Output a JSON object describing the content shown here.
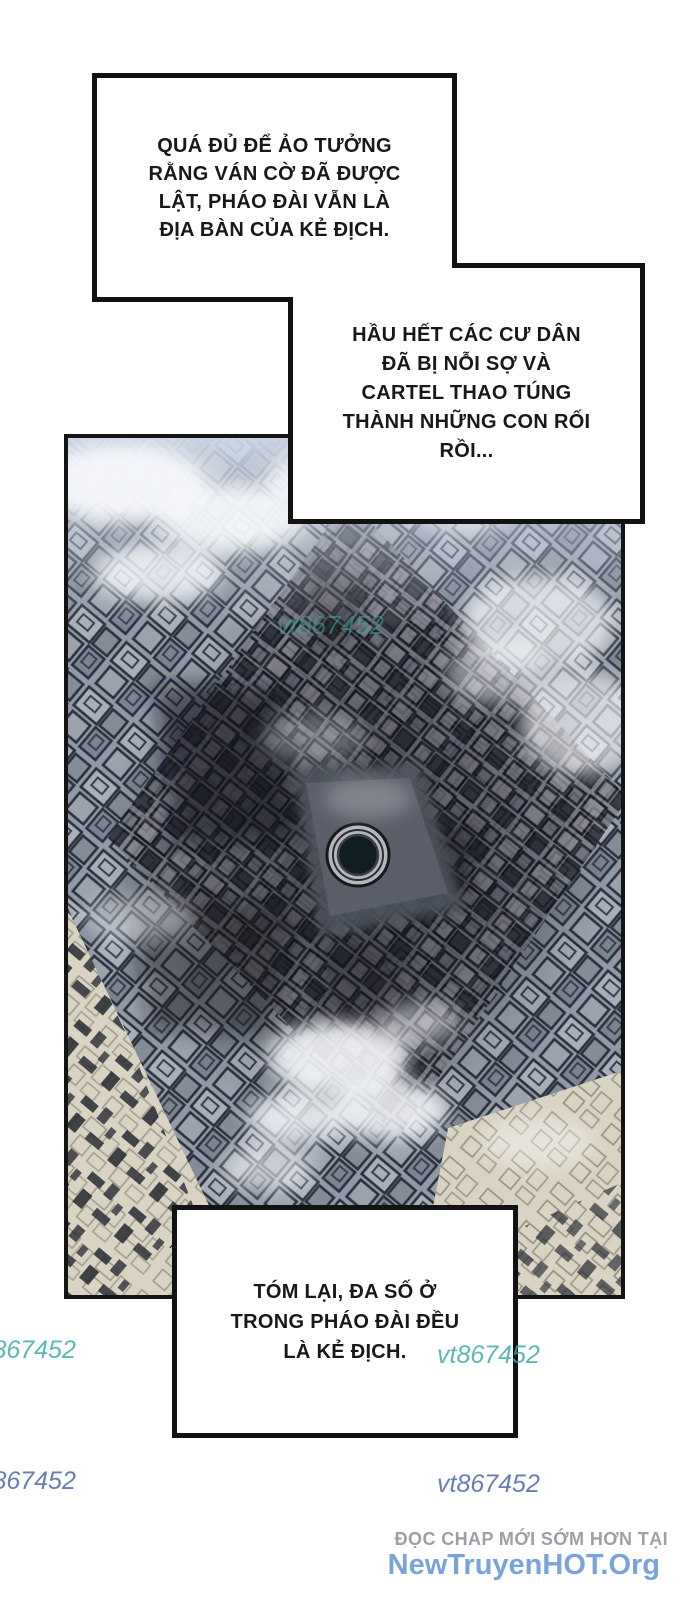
{
  "bubbles": [
    {
      "id": "bubble-1",
      "lines": [
        "QUÁ ĐỦ ĐỂ ẢO TƯỞNG",
        "RẰNG VÁN CỜ ĐÃ ĐƯỢC",
        "LẬT, PHÁO ĐÀI VẪN LÀ",
        "ĐỊA BÀN CỦA KẺ ĐỊCH."
      ]
    },
    {
      "id": "bubble-2",
      "lines": [
        "HẦU HẾT CÁC CƯ DÂN",
        "ĐÃ BỊ NỖI SỢ VÀ",
        "CARTEL THAO TÚNG",
        "THÀNH NHỮNG CON RỐI",
        "RỒI..."
      ]
    },
    {
      "id": "bubble-3",
      "lines": [
        "TÓM LẠI, ĐA SỐ Ở",
        "TRONG PHÁO ĐÀI ĐỀU",
        "LÀ KẺ ĐỊCH."
      ]
    }
  ],
  "watermark": {
    "text": "vt867452"
  },
  "footer": {
    "promo": "ĐỌC CHAP MỚI SỚM HƠN TẠI",
    "site": "NewTruyenHOT.Org"
  },
  "artwork": {
    "name": "fortress-slum-aerial-view"
  },
  "colors": {
    "teal_watermark": "#39a8a4",
    "blue_watermark": "#586ead",
    "promo_gray": "#9aa0a7",
    "site_blue": "#79a3d9",
    "ink": "#121212",
    "paper": "#ffffff"
  }
}
